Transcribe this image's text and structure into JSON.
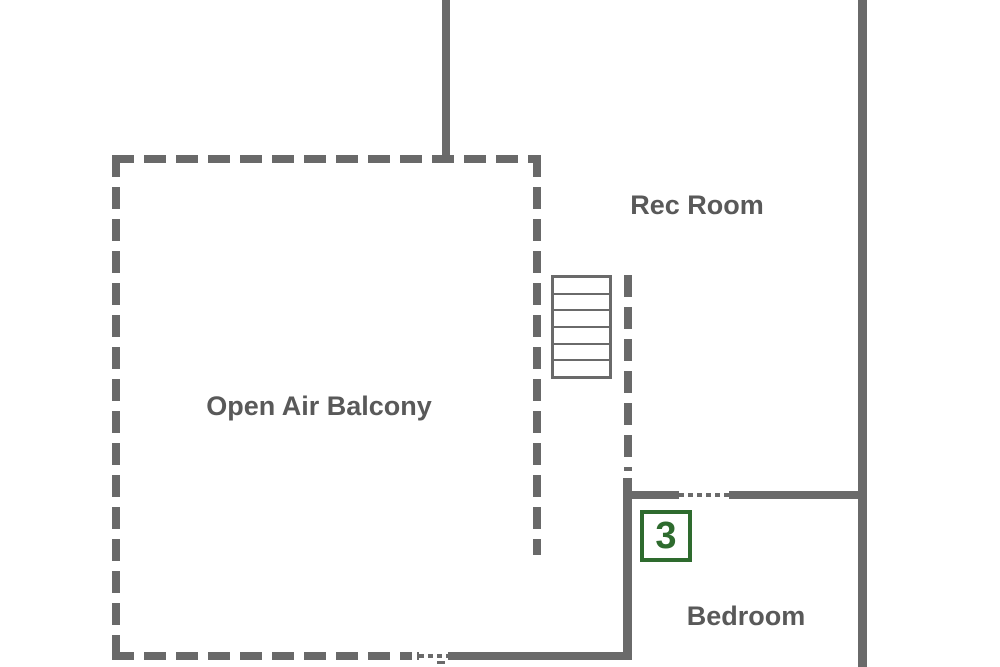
{
  "floorplan": {
    "rooms": {
      "rec_room": {
        "label": "Rec Room"
      },
      "balcony": {
        "label": "Open Air Balcony"
      },
      "bedroom": {
        "label": "Bedroom"
      }
    },
    "marker": {
      "label": "3"
    },
    "stairs": {
      "steps": 6
    },
    "colors": {
      "wall": "#6a6a6a",
      "dash": "#696969",
      "label_text": "#595959",
      "marker_green": "#2e6b2e",
      "background": "#ffffff"
    }
  }
}
